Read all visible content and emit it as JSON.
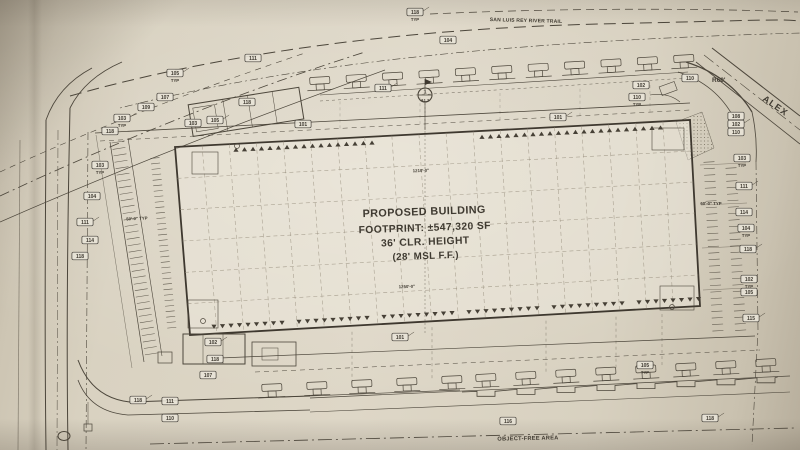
{
  "plan": {
    "trail_label": "SAN LUIS REY RIVER TRAIL",
    "street_label": "ALEX",
    "radius_label": "R60'",
    "object_free_label": "OBJECT-FREE AREA",
    "building": {
      "line1": "PROPOSED BUILDING",
      "line2": "FOOTPRINT: ±547,320 SF",
      "line3": "36' CLR. HEIGHT",
      "line4": "(28' MSL F.F.)"
    },
    "section_marker": {
      "number": "1",
      "sheet": "A1.2"
    },
    "dimensions": [
      {
        "text": "1210'-0\"",
        "x": 421,
        "y": 172,
        "rot": -2
      },
      {
        "text": "1250'-0\"",
        "x": 407,
        "y": 288,
        "rot": -2
      },
      {
        "text": "50'-0\" TYP",
        "x": 137,
        "y": 220,
        "rot": -3
      },
      {
        "text": "60'-0\" TYP",
        "x": 711,
        "y": 205,
        "rot": 0
      }
    ],
    "callouts": [
      {
        "text": "118",
        "sub": "TYP",
        "x": 415,
        "y": 12
      },
      {
        "text": "104",
        "x": 448,
        "y": 40
      },
      {
        "text": "111",
        "x": 253,
        "y": 58
      },
      {
        "text": "105",
        "sub": "TYP",
        "x": 175,
        "y": 73
      },
      {
        "text": "107",
        "x": 165,
        "y": 97
      },
      {
        "text": "109",
        "x": 146,
        "y": 107
      },
      {
        "text": "103",
        "sub": "TYP",
        "x": 122,
        "y": 118
      },
      {
        "text": "118",
        "x": 110,
        "y": 131
      },
      {
        "text": "118",
        "x": 247,
        "y": 102
      },
      {
        "text": "105",
        "x": 215,
        "y": 120
      },
      {
        "text": "103",
        "x": 193,
        "y": 123
      },
      {
        "text": "101",
        "x": 303,
        "y": 124
      },
      {
        "text": "111",
        "x": 383,
        "y": 88
      },
      {
        "text": "102",
        "x": 641,
        "y": 85
      },
      {
        "text": "110",
        "sub": "TYP",
        "x": 637,
        "y": 97
      },
      {
        "text": "101",
        "x": 558,
        "y": 117
      },
      {
        "text": "110",
        "x": 690,
        "y": 78
      },
      {
        "text": "108",
        "x": 736,
        "y": 116
      },
      {
        "text": "102",
        "x": 736,
        "y": 124
      },
      {
        "text": "110",
        "x": 736,
        "y": 132
      },
      {
        "text": "103",
        "sub": "TYP",
        "x": 742,
        "y": 158
      },
      {
        "text": "111",
        "x": 744,
        "y": 186
      },
      {
        "text": "114",
        "x": 744,
        "y": 212
      },
      {
        "text": "104",
        "sub": "TYP",
        "x": 746,
        "y": 228
      },
      {
        "text": "118",
        "x": 748,
        "y": 249
      },
      {
        "text": "102",
        "sub": "TYP",
        "x": 749,
        "y": 279
      },
      {
        "text": "105",
        "x": 749,
        "y": 292
      },
      {
        "text": "115",
        "x": 751,
        "y": 318
      },
      {
        "text": "103",
        "sub": "TYP",
        "x": 100,
        "y": 165
      },
      {
        "text": "104",
        "x": 92,
        "y": 196
      },
      {
        "text": "111",
        "x": 85,
        "y": 222
      },
      {
        "text": "114",
        "x": 90,
        "y": 240
      },
      {
        "text": "118",
        "x": 80,
        "y": 256
      },
      {
        "text": "102",
        "x": 213,
        "y": 342
      },
      {
        "text": "118",
        "x": 215,
        "y": 359
      },
      {
        "text": "107",
        "x": 208,
        "y": 375
      },
      {
        "text": "118",
        "x": 138,
        "y": 400
      },
      {
        "text": "111",
        "x": 170,
        "y": 401
      },
      {
        "text": "110",
        "x": 170,
        "y": 418
      },
      {
        "text": "101",
        "x": 400,
        "y": 337
      },
      {
        "text": "105",
        "sub": "TYP",
        "x": 645,
        "y": 365
      },
      {
        "text": "116",
        "x": 508,
        "y": 421
      },
      {
        "text": "118",
        "x": 710,
        "y": 418
      }
    ]
  }
}
